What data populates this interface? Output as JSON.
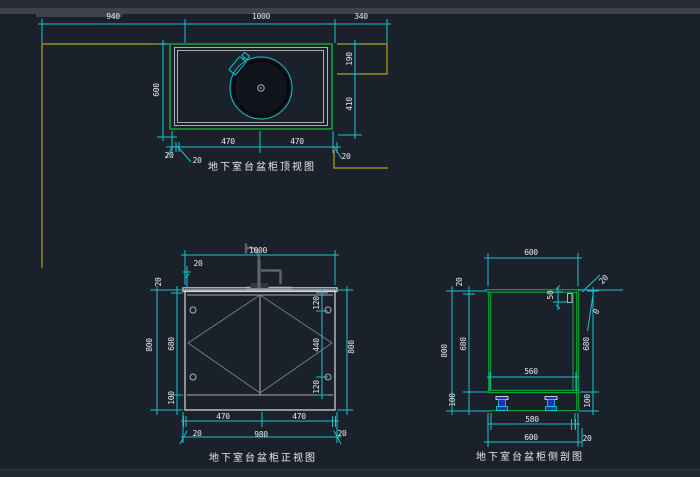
{
  "colors": {
    "bg": "#1b212b",
    "bar_dark": "#262b33",
    "bar_mid": "#3d4450",
    "statusbar": "#242a34",
    "statusbar_border": "#2e3642",
    "cyan": "#1ac3cf",
    "green": "#0ca63a",
    "yellow": "#b1a51f",
    "white_line": "#d6dade",
    "gray_line": "#7b828b",
    "text": "#e6e9ed",
    "sink_fill": "#10141b",
    "sink_ring": "#06090e",
    "faucet_gray": "#5d646d",
    "faucet_dark": "#31373f",
    "strip_gray": "#454b54",
    "feet_blue": "#1f2fae",
    "feet_cyan": "#19c7d1",
    "knob": "#aab0b8"
  },
  "views": {
    "top_view": {
      "title": "地下室台盆柜顶视图",
      "dims": {
        "total_left": "940",
        "total_center": "1000",
        "total_right": "340",
        "depth": "600",
        "right_upper": "190",
        "right_lower": "410",
        "bottom_left_half": "470",
        "bottom_right_half": "470",
        "offset_a": "20",
        "offset_b": "20",
        "offset_c": "20"
      }
    },
    "front_view": {
      "title": "地下室台盆柜正视图",
      "dims": {
        "top_width": "1000",
        "top_offset": "20",
        "left_total": "800",
        "counter_thickness": "20",
        "door_height": "680",
        "plinth_height": "100",
        "inner_top": "120",
        "inner_middle": "440",
        "inner_bottom": "120",
        "right_total": "800",
        "bottom_left_half": "470",
        "bottom_right_half": "470",
        "bottom_offset_left": "20",
        "bottom_width": "980",
        "bottom_offset_right": "20"
      }
    },
    "side_view": {
      "title": "地下室台盆柜侧剖图",
      "dims": {
        "top_depth": "600",
        "left_counter": "20",
        "left_total": "800",
        "left_door": "680",
        "left_plinth": "100",
        "rail_height": "50",
        "top_right_offset": "20",
        "top_right_zero": "0",
        "right_door": "680",
        "right_plinth": "100",
        "inner_depth": "560",
        "bottom_inner": "580",
        "bottom_depth": "600",
        "bottom_offset": "20"
      }
    }
  }
}
